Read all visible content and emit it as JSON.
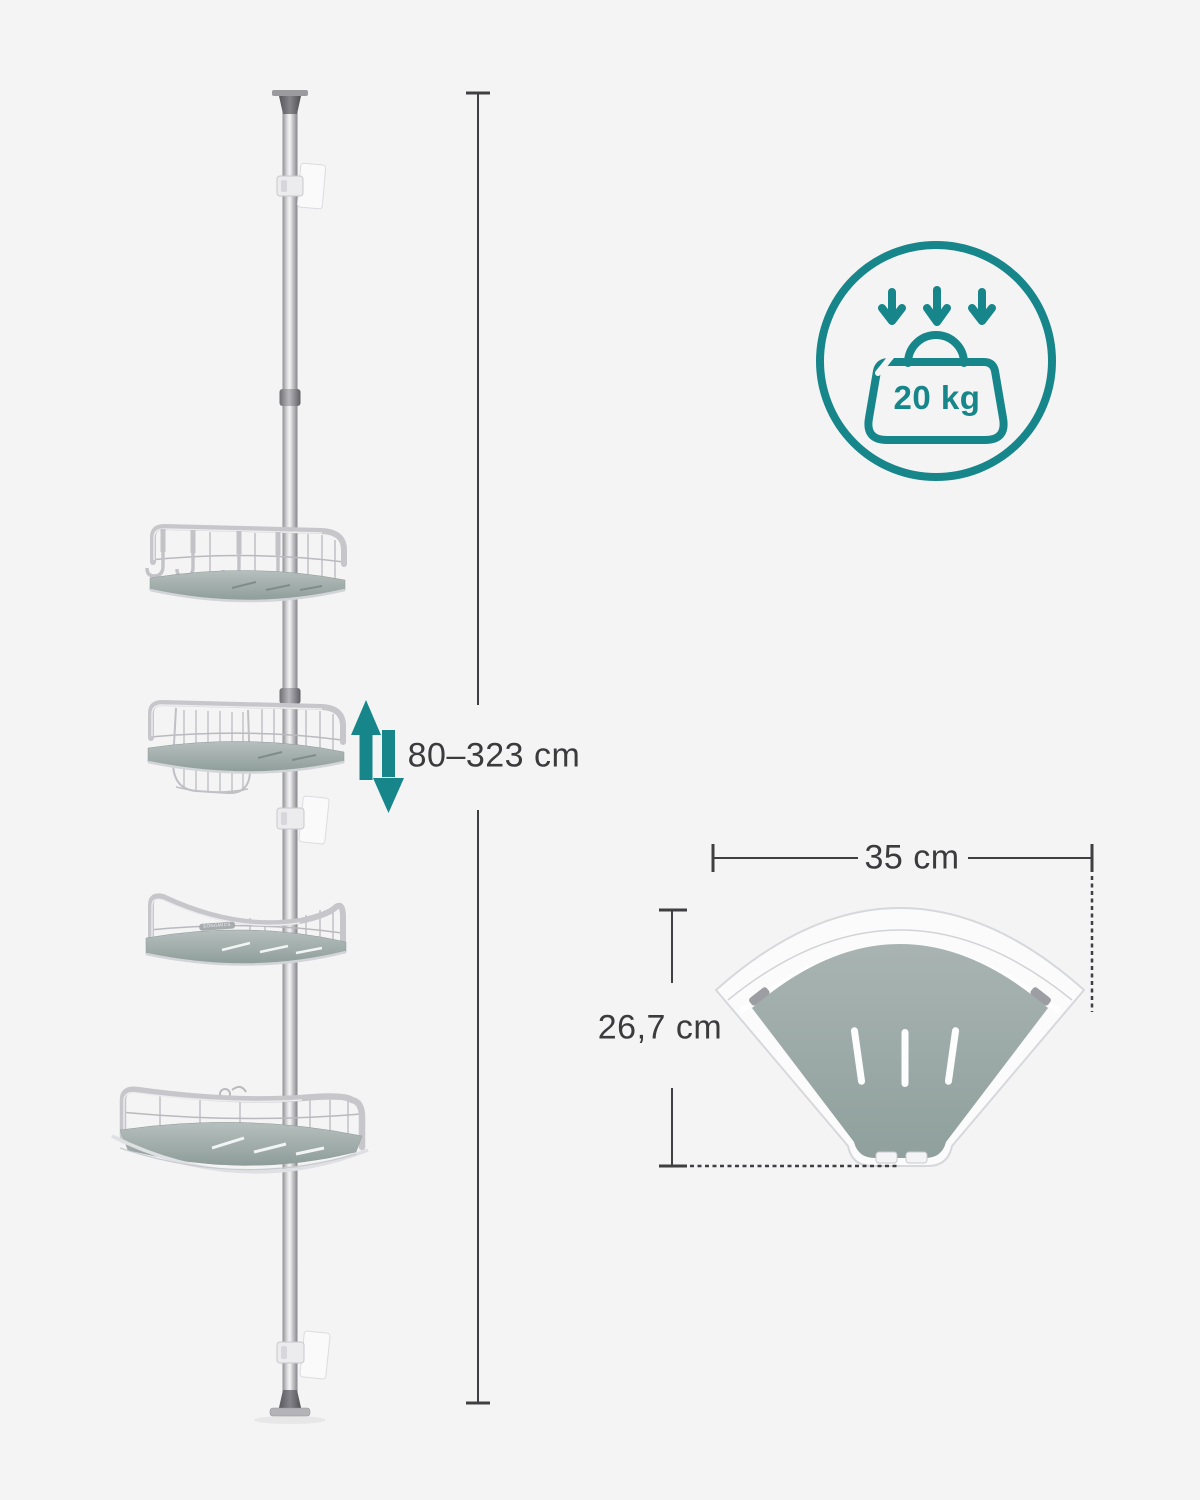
{
  "canvas": {
    "width": 1200,
    "height": 1500,
    "background": "#f4f4f5"
  },
  "colors": {
    "accent_teal": "#17868a",
    "dimension_line": "#3f3f41",
    "text": "#3b3b3d",
    "pole_silver": "#c9c9ce",
    "shelf_surface_concrete": "#9fabaa"
  },
  "figure": {
    "type": "telescopic corner shower caddy with 4 trays",
    "brand_label": "SONGMICS",
    "shelf_count": 4
  },
  "labels": {
    "height_range": "80–323 cm",
    "max_load": "20 kg",
    "top_view_width": "35 cm",
    "top_view_depth": "26,7 cm"
  },
  "icons": {
    "max_load": "weight-bag-icon",
    "load_direction": "triple-down-arrow-icon",
    "height_adjust": "up-down-arrow-icon",
    "dimension_markers": "dimension-line-ticks"
  }
}
